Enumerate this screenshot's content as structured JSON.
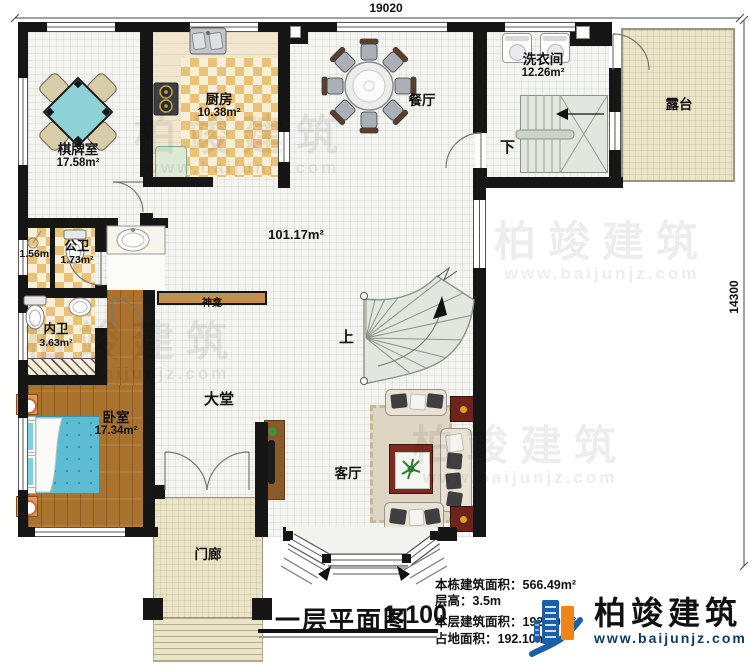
{
  "plan": {
    "dimensions": {
      "top": "19020",
      "right": "14300"
    },
    "rooms": {
      "qipaishi": {
        "name": "棋牌室",
        "area": "17.58m²"
      },
      "chufang": {
        "name": "厨房",
        "area": "10.38m²"
      },
      "canting": {
        "name": "餐厅"
      },
      "xiyijian": {
        "name": "洗衣间",
        "area": "12.26m²"
      },
      "lutai": {
        "name": "露台"
      },
      "linyu": {
        "area": "1.56m²"
      },
      "gongwei": {
        "name": "公卫",
        "area": "1.73m²"
      },
      "neiwei": {
        "name": "内卫",
        "area": "3.63m²"
      },
      "woshi": {
        "name": "卧室",
        "area": "17.34m²"
      },
      "datang": {
        "name": "大堂",
        "area": "101.17m²"
      },
      "keting": {
        "name": "客厅"
      },
      "menlang": {
        "name": "门廊"
      },
      "shenkan": {
        "name": "神龛"
      }
    },
    "stairs": {
      "up": "上",
      "down": "下"
    }
  },
  "title_block": {
    "title": "一层平面图",
    "scale": "1:100",
    "lines": [
      {
        "label": "本栋建筑面积：",
        "value": "566.49m²"
      },
      {
        "label": "层高：",
        "value": "3.5m"
      },
      {
        "label": "本层建筑面积：",
        "value": "192.10m²"
      },
      {
        "label": "占地面积：",
        "value": "192.10m²"
      }
    ]
  },
  "branding": {
    "name": "柏竣建筑",
    "url": "www.baijunjz.com"
  },
  "colors": {
    "wall": "#161616",
    "logo_blue": "#1a5fa8",
    "logo_orange": "#f08418",
    "bed": "#5bbcd4",
    "table_cyan": "#8ed2d6",
    "terrace": "#ebe4c6",
    "wood": "#a9732e",
    "checker": "#e9c177"
  }
}
